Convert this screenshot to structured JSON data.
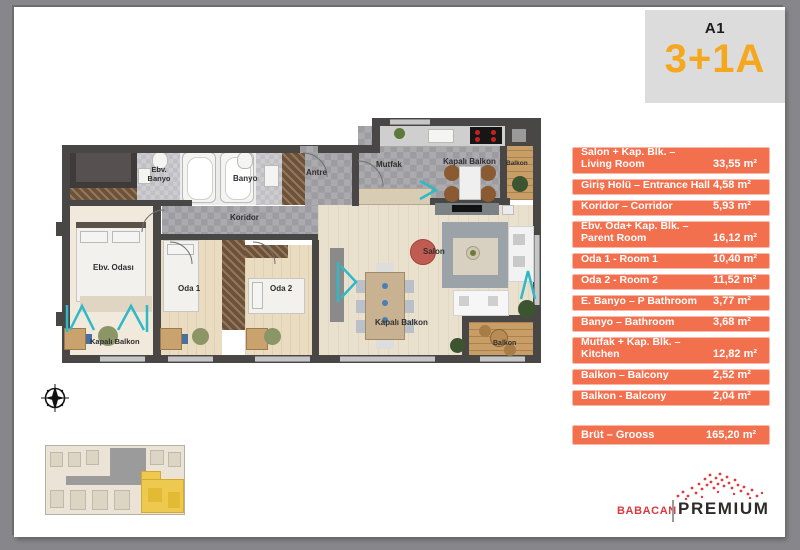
{
  "unit": {
    "block_label": "A1",
    "type_label": "3+1A"
  },
  "areas": {
    "rows": [
      {
        "line1": "Salon + Kap. Blk.  –",
        "line2": "Living Room",
        "value": "33,55 m²"
      },
      {
        "line1": "Giriş Holü – Entrance Hall",
        "line2": "",
        "value": "4,58 m²"
      },
      {
        "line1": "Koridor – Corridor",
        "line2": "",
        "value": "5,93 m²"
      },
      {
        "line1": "Ebv. Oda+ Kap. Blk. –",
        "line2": "Parent Room",
        "value": "16,12 m²"
      },
      {
        "line1": "Oda 1  - Room 1",
        "line2": "",
        "value": "10,40 m²"
      },
      {
        "line1": "Oda 2  - Room 2",
        "line2": "",
        "value": "11,52 m²"
      },
      {
        "line1": "E. Banyo – P Bathroom",
        "line2": "",
        "value": "3,77 m²"
      },
      {
        "line1": "Banyo – Bathroom",
        "line2": "",
        "value": "3,68 m²"
      },
      {
        "line1": "Mutfak + Kap. Blk. –",
        "line2": "Kitchen",
        "value": "12,82 m²"
      },
      {
        "line1": "Balkon – Balcony",
        "line2": "",
        "value": "2,52 m²"
      },
      {
        "line1": "Balkon  - Balcony",
        "line2": "",
        "value": "2,04 m²"
      },
      {
        "line1": "Brüt – Grooss",
        "line2": "",
        "value": "165,20 m²"
      }
    ]
  },
  "plan": {
    "labels": {
      "ebv_banyo": "Ebv.\nBanyo",
      "banyo": "Banyo",
      "koridor": "Koridor",
      "antre": "Antre",
      "mutfak": "Mutfak",
      "kapali_balkon_top": "Kapalı Balkon",
      "balkon_top": "Balkon",
      "salon": "Salon",
      "ebv_odasi": "Ebv. Odası",
      "oda1": "Oda 1",
      "oda2": "Oda 2",
      "kapali_balkon_left": "Kapalı Balkon",
      "kapali_balkon_center": "Kapalı Balkon",
      "balkon_bottom": "Balkon"
    }
  },
  "logo": {
    "brand": "BABACAN",
    "premium": "PREMIUM"
  },
  "colors": {
    "accent_orange": "#f2704e",
    "accent_amber": "#f5a81d",
    "teal_glass": "#2fb9c7",
    "brand_red": "#e13a3e",
    "wall_dark": "#494745",
    "keyplan_highlight": "#edc94f"
  }
}
